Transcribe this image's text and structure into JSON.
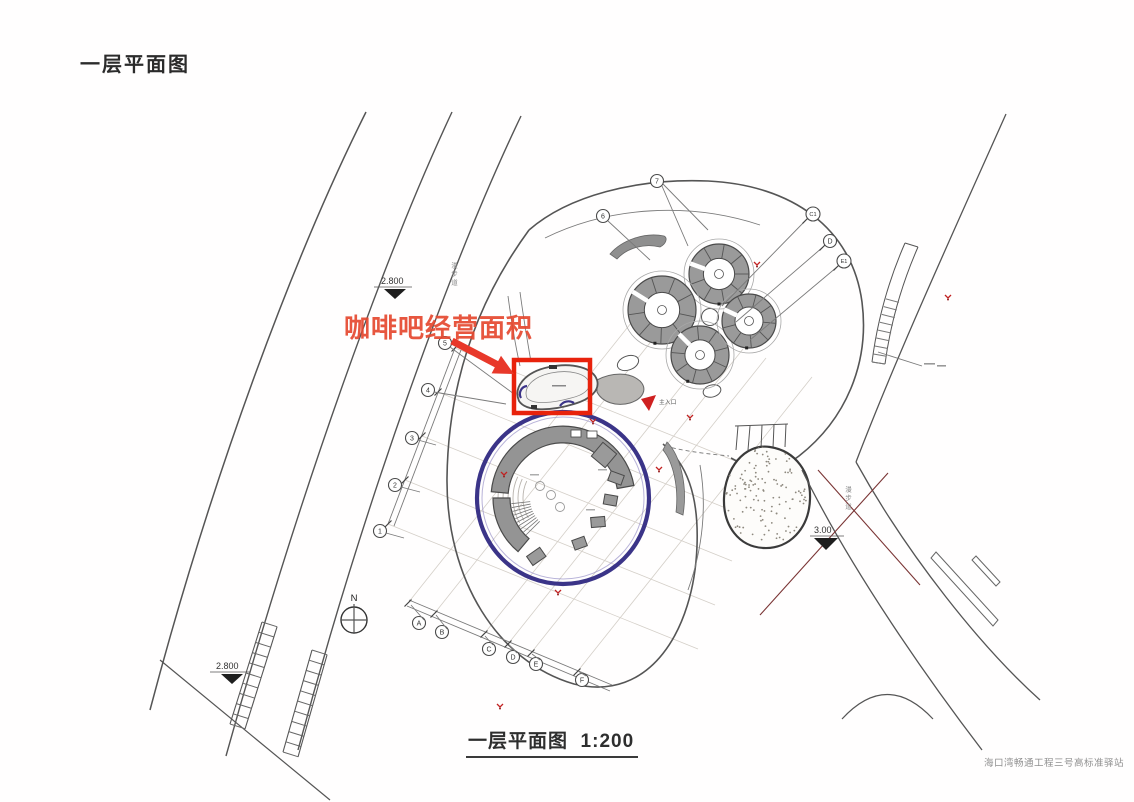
{
  "title": "一层平面图",
  "caption": "一层平面图  1:200",
  "watermark": "海口湾畅通工程三号高标准驿站",
  "annotation": "咖啡吧经营面积",
  "labels": {
    "main_entrance": "主入口",
    "north": "N",
    "footpath": "漫步道",
    "elev_top": "2.800",
    "elev_bottom": "2.800",
    "elev_right": "3.00"
  },
  "grid": {
    "left": [
      "1",
      "2",
      "3",
      "4",
      "5"
    ],
    "top": [
      "6",
      "7"
    ],
    "right": [
      "C1",
      "D",
      "E1"
    ],
    "bottom": [
      "A",
      "B",
      "C",
      "D",
      "E",
      "F"
    ]
  },
  "colors": {
    "highlight_red": "#e8220c",
    "annotation_red": "#e5482f",
    "ring_blue": "#3b3488",
    "building_gray": "#969696"
  }
}
